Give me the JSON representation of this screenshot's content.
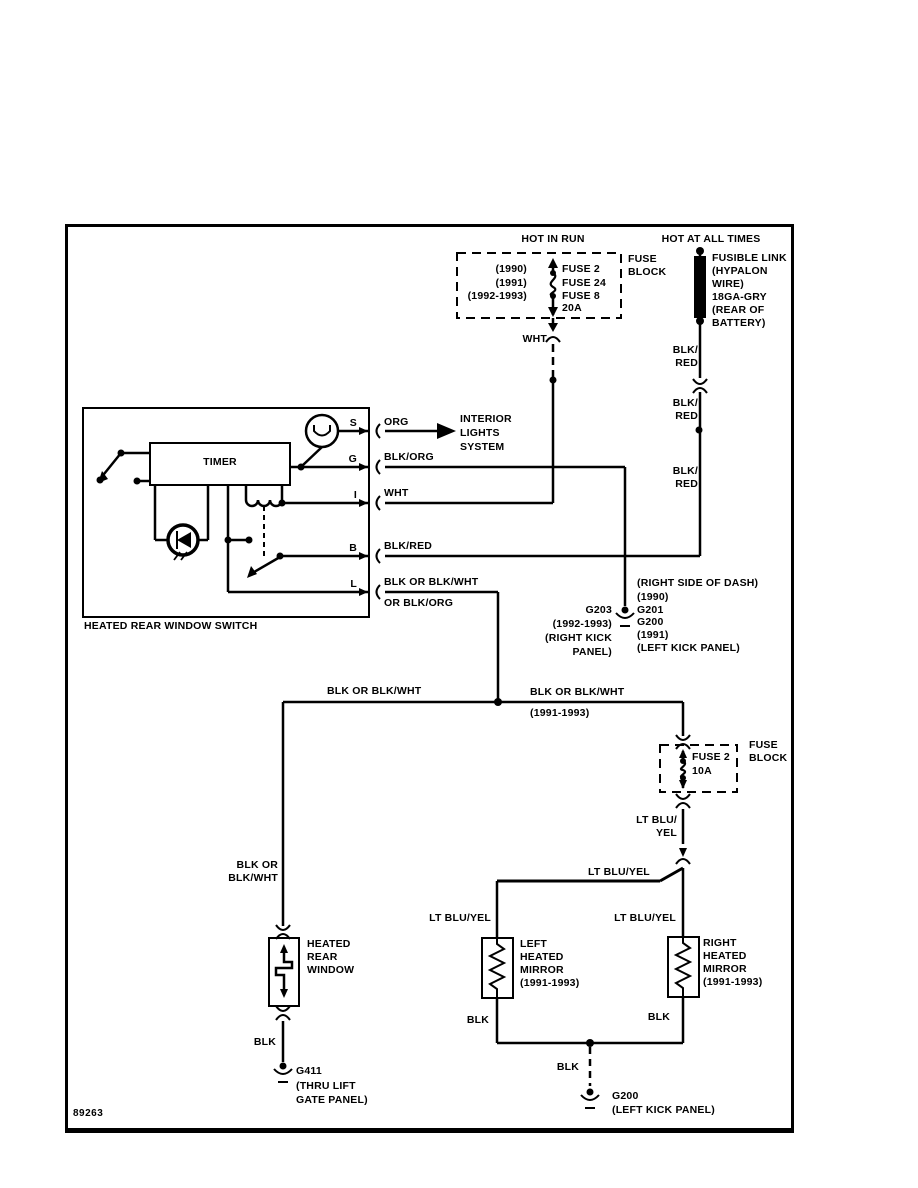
{
  "footer": {
    "diagram_number": "89263"
  },
  "power": {
    "hot_in_run": "HOT IN RUN",
    "hot_at_all_times": "HOT AT ALL TIMES",
    "ignition_fuse_block": {
      "name_lines": [
        "FUSE",
        "BLOCK"
      ],
      "years": [
        "(1990)",
        "(1991)",
        "(1992-1993)"
      ],
      "fuses": [
        "FUSE 2",
        "FUSE 24",
        "FUSE 8"
      ],
      "rating": "20A"
    },
    "fusible_link_lines": [
      "FUSIBLE LINK",
      "(HYPALON",
      "WIRE)",
      "18GA-GRY",
      "(REAR OF",
      "BATTERY)"
    ]
  },
  "wires": {
    "wht": "WHT",
    "org": "ORG",
    "blk_org": "BLK/ORG",
    "blk_red": "BLK/RED",
    "blk_red_split": [
      "BLK/",
      "RED"
    ],
    "l_wire_lines": [
      "BLK OR BLK/WHT",
      "OR BLK/ORG"
    ],
    "main_left": "BLK OR BLK/WHT",
    "main_right_lines": [
      "BLK OR BLK/WHT",
      "(1991-1993)"
    ],
    "left_drop_lines": [
      "BLK OR",
      "BLK/WHT"
    ],
    "lt_blu_yel_split": [
      "LT BLU/",
      "YEL"
    ],
    "lt_blu_yel": "LT BLU/YEL",
    "blk": "BLK"
  },
  "switch": {
    "label": "HEATED REAR WINDOW SWITCH",
    "timer": "TIMER",
    "terminals": [
      "S",
      "G",
      "I",
      "B",
      "L"
    ]
  },
  "interior_lights_lines": [
    "INTERIOR",
    "LIGHTS",
    "SYSTEM"
  ],
  "mid_fuse": {
    "name_lines": [
      "FUSE",
      "BLOCK"
    ],
    "fuse": "FUSE 2",
    "rating": "10A"
  },
  "components": {
    "heated_rear_window_lines": [
      "HEATED",
      "REAR",
      "WINDOW"
    ],
    "left_mirror_lines": [
      "LEFT",
      "HEATED",
      "MIRROR",
      "(1991-1993)"
    ],
    "right_mirror_lines": [
      "RIGHT",
      "HEATED",
      "MIRROR",
      "(1991-1993)"
    ]
  },
  "grounds": {
    "g203_left_lines": [
      "G203",
      "(1992-1993)",
      "(RIGHT KICK",
      "PANEL)"
    ],
    "g203_right_lines": [
      "(RIGHT SIDE OF DASH)",
      "(1990)",
      "G201",
      "G200",
      "(1991)",
      "(LEFT KICK PANEL)"
    ],
    "g411_lines": [
      "G411",
      "(THRU LIFT",
      "GATE PANEL)"
    ],
    "g200_lines": [
      "G200",
      "(LEFT KICK PANEL)"
    ]
  }
}
